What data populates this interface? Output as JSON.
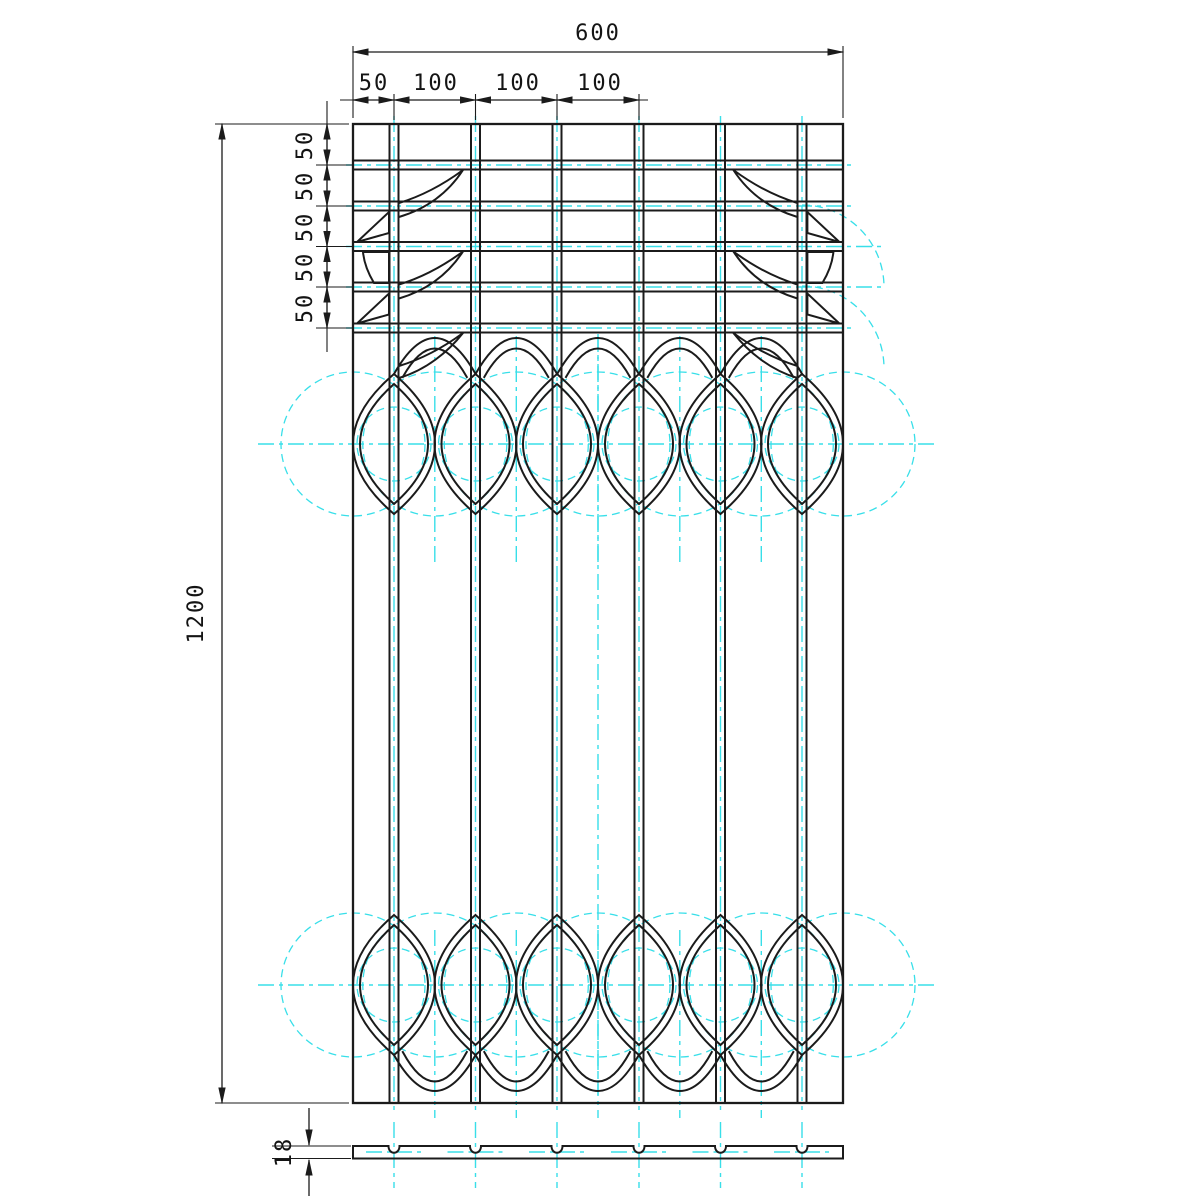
{
  "drawing": {
    "kind": "technical-drawing",
    "views": {
      "front_view": "decorative-grille-panel",
      "bottom_view": "panel-thickness-profile"
    }
  },
  "dimensions": {
    "width": "600",
    "height": "1200",
    "thickness": "18",
    "top_chain": [
      "50",
      "100",
      "100",
      "100"
    ],
    "left_chain": [
      "50",
      "50",
      "50",
      "50",
      "50"
    ]
  },
  "colors": {
    "line": "#1b1b1b",
    "construction": "#38dfe9",
    "background": "#ffffff"
  }
}
